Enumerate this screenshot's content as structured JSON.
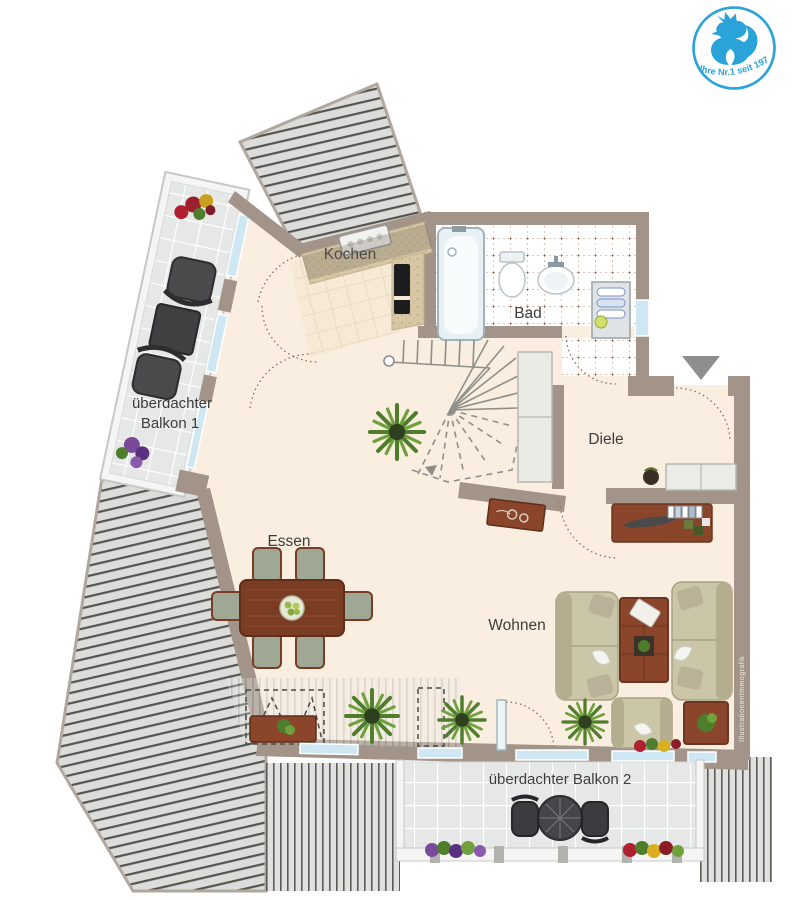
{
  "logo": {
    "tagline": "Ihre Nr.1 seit 1975",
    "icon": "rooster-icon",
    "accent_color": "#2aa3d8"
  },
  "rooms": {
    "kochen": {
      "label": "Kochen"
    },
    "bad": {
      "label": "Bad"
    },
    "diele": {
      "label": "Diele"
    },
    "essen": {
      "label": "Essen"
    },
    "wohnen": {
      "label": "Wohnen"
    },
    "balkon1": {
      "label_line1": "überdachter",
      "label_line2": "Balkon 1"
    },
    "balkon2": {
      "label": "überdachter Balkon 2"
    }
  },
  "icons": {
    "entrance_arrow": "▼"
  },
  "watermark": {
    "text": "IllustrationenImmografik"
  },
  "palette": {
    "wall": "#a29488",
    "floor": "#faeee0",
    "roof_stripe_bg": "#dcdddb",
    "roof_stripe_line": "#55544f",
    "wood": "#8a452a",
    "sofa": "#cbc6a8",
    "window": "#cfe7f2",
    "balcony_tile": "#e6e8e7",
    "label_text": "#3c3c3c",
    "logo_blue": "#2aa3d8"
  }
}
